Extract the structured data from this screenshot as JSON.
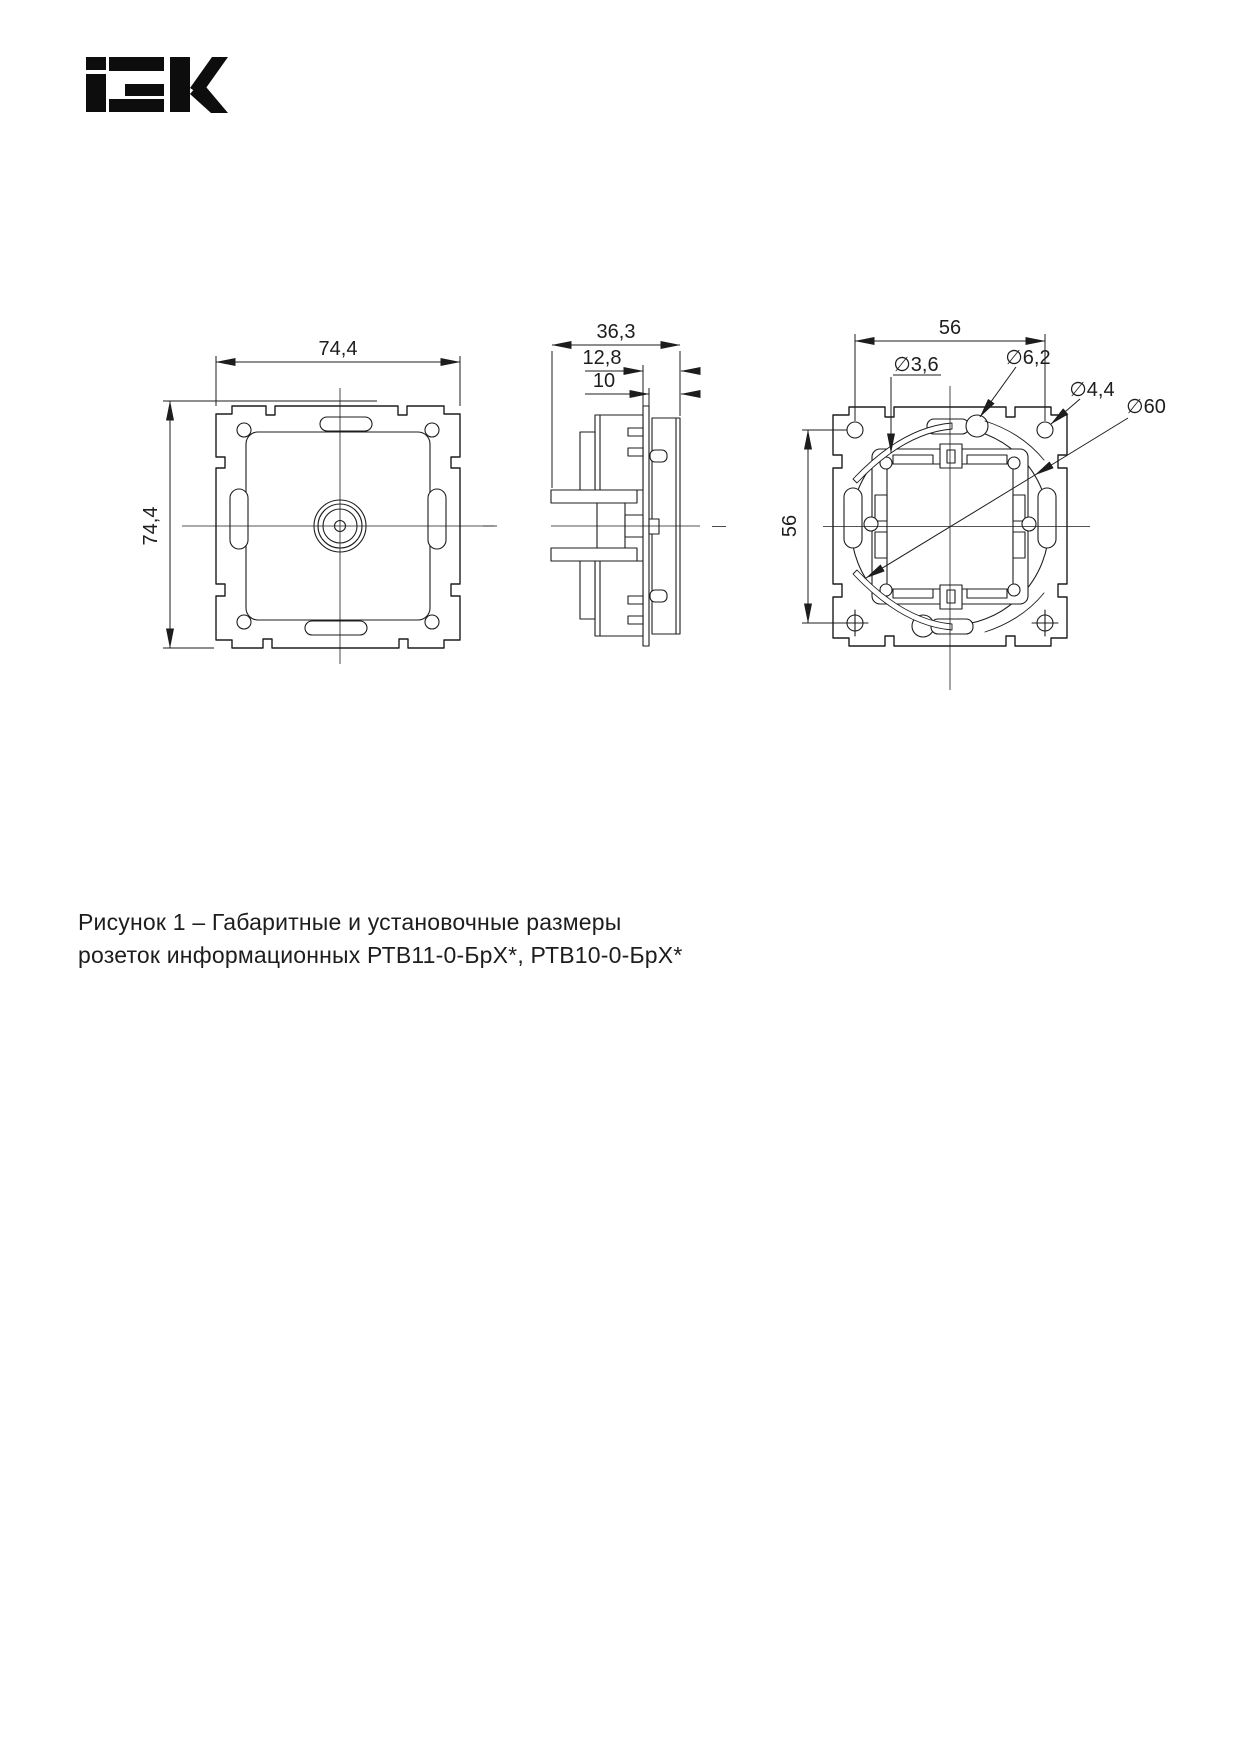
{
  "page": {
    "background": "#ffffff",
    "ink": "#1d1d1b"
  },
  "logo": {
    "brand": "IEK"
  },
  "drawing": {
    "front_view": {
      "dim_width": "74,4",
      "dim_height": "74,4"
    },
    "side_view": {
      "dim_depth_total": "36,3",
      "dim_depth_cover": "12,8",
      "dim_depth_frame": "10"
    },
    "back_view": {
      "dim_hole_span_horizontal": "56",
      "dim_hole_span_vertical": "56",
      "dia_fixing_hole": "∅3,6",
      "dia_slot": "∅6,2",
      "dia_claw_hole": "∅4,4",
      "dia_mounting_circle": "∅60"
    }
  },
  "caption": {
    "line1": "Рисунок 1 – Габаритные и установочные размеры",
    "line2": "розеток информационных РТВ11-0-БрХ*, РТВ10-0-БрХ*"
  }
}
